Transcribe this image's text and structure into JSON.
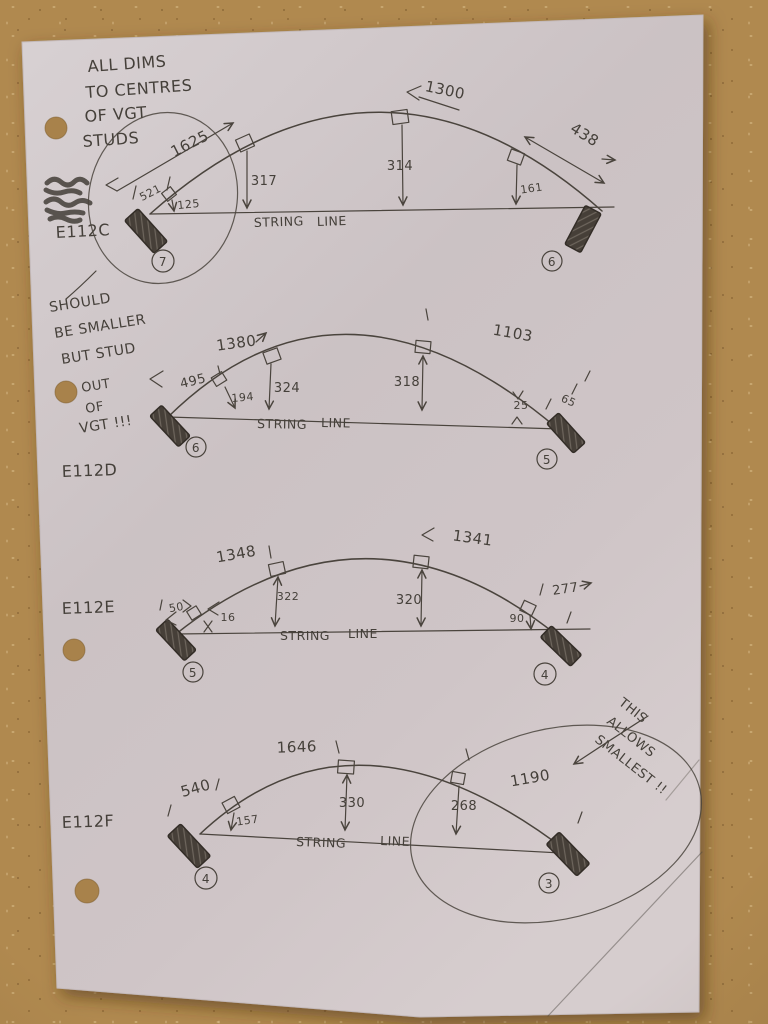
{
  "photo": {
    "cork_color": "#b0894f",
    "paper_color": "#cfc6c8",
    "ink_color": "#45403a"
  },
  "header_note": {
    "lines": [
      "ALL DIMS",
      "TO CENTRES",
      "OF VGT",
      "STUDS"
    ]
  },
  "side_note": {
    "lines": [
      "SHOULD",
      "BE SMALLER",
      "BUT STUD",
      "OUT",
      "OF",
      "VGT !!!"
    ]
  },
  "smallest_note": {
    "lines": [
      "THIS",
      "ALLOWS",
      "SMALLEST !!"
    ]
  },
  "string_line": {
    "word1": "STRING",
    "word2": "LINE"
  },
  "diagrams": [
    {
      "label": "E112C",
      "left_node": "7",
      "right_node": "6",
      "dims": {
        "diag_left": "1625",
        "left_offset": "521",
        "drop1": "125",
        "drop2": "317",
        "drop3": "314",
        "top": "1300",
        "drop4": "161",
        "diag_right": "438"
      }
    },
    {
      "label": "E112D",
      "left_node": "6",
      "right_node": "5",
      "dims": {
        "top": "1380",
        "diag_left": "495",
        "drop1": "194",
        "drop2": "324",
        "drop3": "318",
        "top_right": "1103",
        "drop4": "25",
        "right_offset": "65"
      }
    },
    {
      "label": "E112E",
      "left_node": "5",
      "right_node": "4",
      "dims": {
        "top": "1348",
        "left_offset": "50",
        "gap": "16",
        "drop1": "322",
        "top_right": "1341",
        "drop2": "320",
        "drop3": "90",
        "right_offset": "277"
      }
    },
    {
      "label": "E112F",
      "left_node": "4",
      "right_node": "3",
      "dims": {
        "top": "1646",
        "left_offset": "540",
        "drop1": "157",
        "drop2": "330",
        "drop3": "268",
        "top_right": "1190"
      }
    }
  ]
}
